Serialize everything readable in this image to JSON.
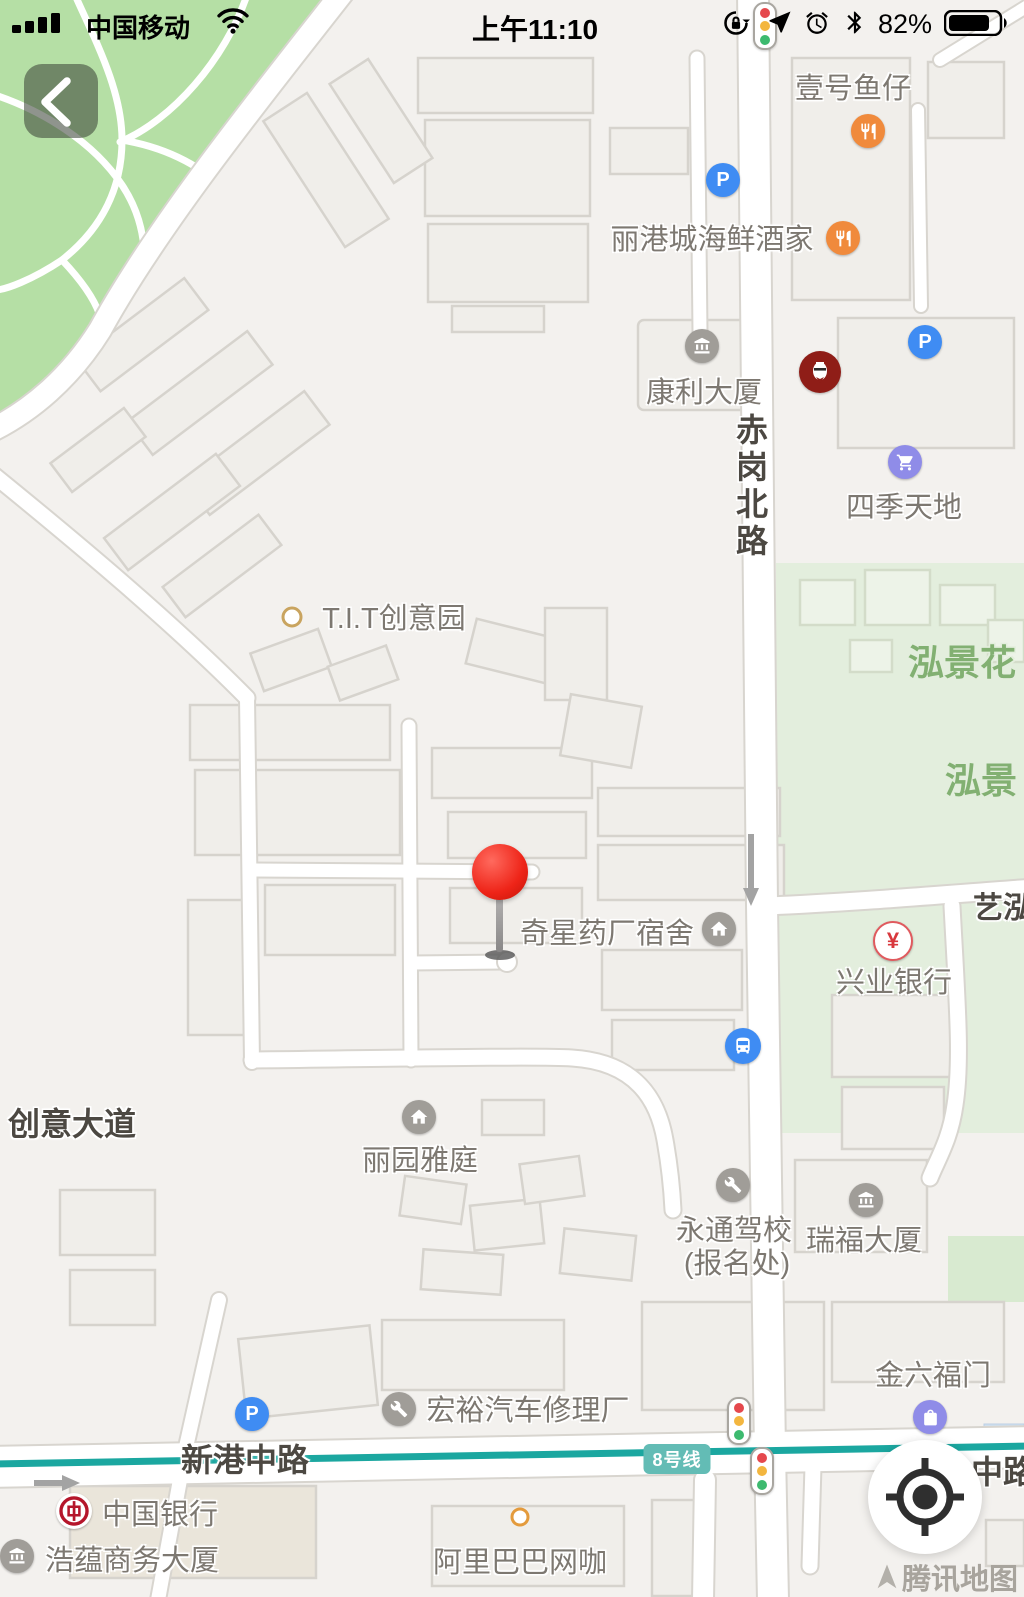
{
  "status_bar": {
    "carrier": "中国移动",
    "time": "上午11:10",
    "battery_percent": "82%"
  },
  "map": {
    "road_labels": {
      "chigang_north_rd": "赤岗北路",
      "xingang_middle_rd": "新港中路",
      "road_fragment_right": "中路",
      "chuangyi_avenue": "创意大道",
      "yihong_fragment": "艺泓"
    },
    "area_labels": {
      "hongjing_garden_fragment": "泓景花",
      "hongjing_fragment": "泓景"
    },
    "pois": {
      "yihao_yuzai": "壹号鱼仔",
      "ligangcheng_seafood": "丽港城海鲜酒家",
      "kangli_building": "康利大厦",
      "siji_tiandi": "四季天地",
      "tit_creative_park": "T.I.T创意园",
      "qixing_pharma_dormitory": "奇星药厂宿舍",
      "xingye_bank": "兴业银行",
      "liyuan_yating": "丽园雅庭",
      "yongtong_driving_school": "永通驾校",
      "yongtong_registration": "(报名处)",
      "ruifu_building": "瑞福大厦",
      "jinliufu_men": "金六福门",
      "hongyu_auto_repair": "宏裕汽车修理厂",
      "bank_of_china": "中国银行",
      "haoyun_business_building": "浩蕴商务大厦",
      "alibaba_net_cafe": "阿里巴巴网咖"
    },
    "metro": {
      "line_badge": "8号线"
    },
    "icon_glyphs": {
      "parking": "P",
      "yuan": "¥"
    },
    "watermark": "腾讯地图"
  },
  "colors": {
    "park_green": "#b5dfa5",
    "residential_green": "#e3eedd",
    "metro_teal": "#1ba7a0",
    "poi_blue": "#3f8cf3",
    "poi_orange": "#f08a3c",
    "poi_purple": "#8f8ce8",
    "poi_gray": "#a09d98",
    "pin_red": "#ee2418",
    "boc_red": "#b5162b",
    "kfc_red": "#8f1d17"
  }
}
